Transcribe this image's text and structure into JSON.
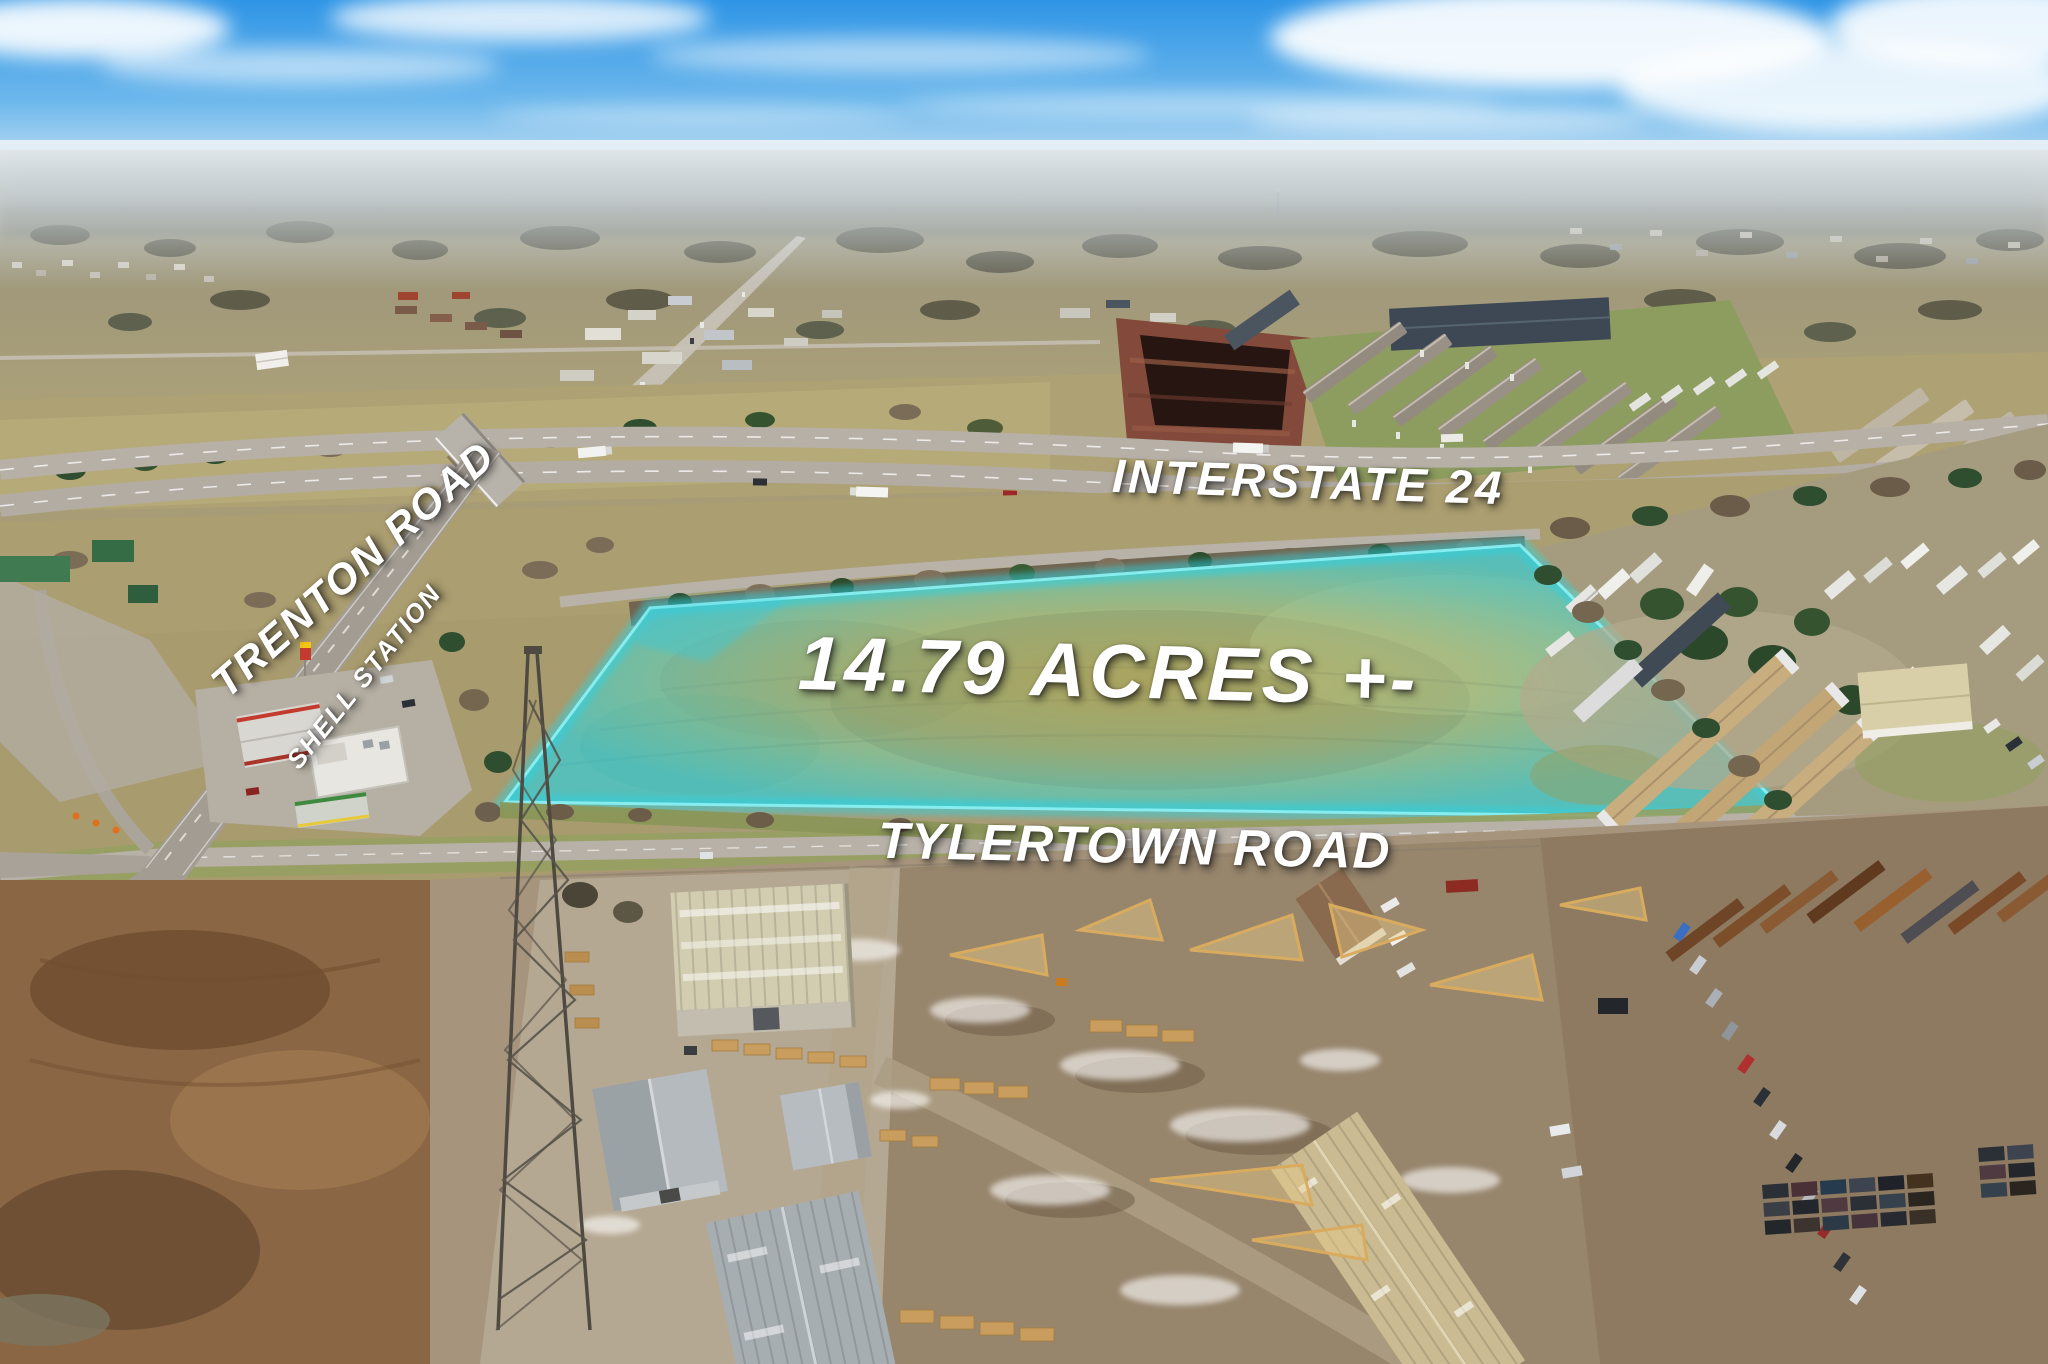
{
  "photo": {
    "labels": {
      "acreage": "14.79 ACRES +-",
      "interstate": "INTERSTATE 24",
      "tylertown_road": "TYLERTOWN ROAD",
      "trenton_road": "TRENTON ROAD",
      "shell_station": "SHELL STATION"
    },
    "colors": {
      "parcel_highlight": "#8df2f5",
      "label_text": "#ffffff",
      "sky": "#3d9ce6"
    }
  }
}
